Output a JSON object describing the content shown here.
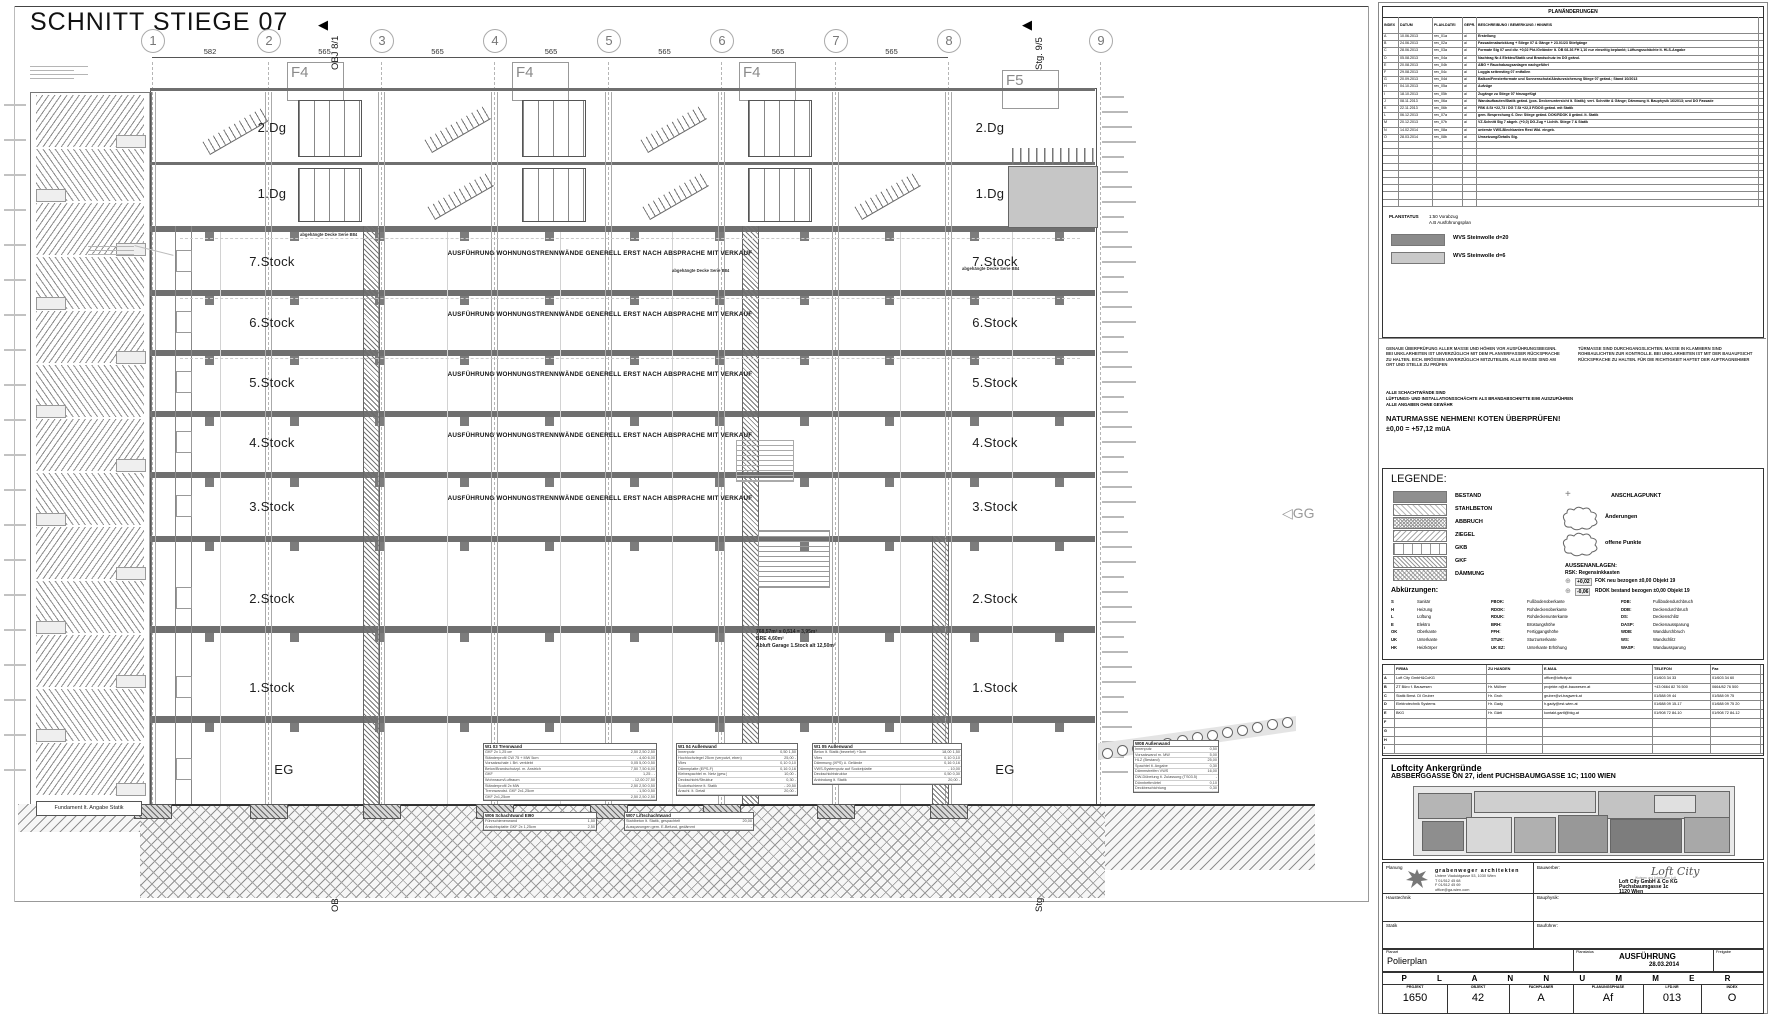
{
  "sheet_title": "SCHNITT STIEGE 07",
  "drawing": {
    "grid_numbers": [
      "1",
      "2",
      "3",
      "4",
      "5",
      "6",
      "7",
      "8",
      "9"
    ],
    "dims": [
      "582",
      "565",
      "565",
      "565",
      "565",
      "565",
      "565"
    ],
    "markers": [
      {
        "label": "OBJ 8/1"
      },
      {
        "label": "Stg. 9/5"
      }
    ],
    "facade_labels": [
      "F4",
      "F4",
      "F4",
      "F5"
    ],
    "floor_labels": [
      "2.Dg",
      "1.Dg",
      "7.Stock",
      "6.Stock",
      "5.Stock",
      "4.Stock",
      "3.Stock",
      "2.Stock",
      "1.Stock",
      "EG"
    ],
    "wall_note": "AUSFÜHRUNG WOHNUNGSTRENNWÄNDE GENERELL ERST NACH ABSPRACHE MIT VERKAUF",
    "ceiling_note": "abgehängte Decke Serie B84",
    "area_notes": [
      "768,57m² x 0,514 = 3,95m³",
      "BRE 4,60m²",
      "Abluft Garage 1.Stock alt 12,50m²"
    ],
    "foundation_note": "Fundament lt. Angabe Statik",
    "gg_label": "GG",
    "spec_tables": [
      {
        "title": "W1 03 Trennwand",
        "rows": [
          [
            "GKF 2x 1,25 cm",
            "2,50 2,50 2,50"
          ],
          [
            "Ständerprofil CW 75 + MW 5cm",
            "- 4,60 6,00"
          ],
          [
            "Vorsatzschale i. Brt. verklebt",
            "0,05 5,00 0,50"
          ],
          [
            "Beton/Brandschutzpl. m. Anstrich",
            "7,50 7,50 6,00"
          ],
          [
            "GKF",
            "1,25 - -"
          ],
          [
            "Wohnraum/Luftraum",
            "- 12,00 27,50"
          ],
          [
            "Ständerprofil 2x MW",
            "2,50 2,50 0,50"
          ],
          [
            "Trennwandst. GKF 2x1,25cm",
            "- 1,50 0,50"
          ],
          [
            "GKF 2x1,25cm",
            "2,50 2,50 2,50"
          ]
        ]
      },
      {
        "title": "W1 04 Außenwand",
        "rows": [
          [
            "Innenputz",
            "0,50 1,50"
          ],
          [
            "Hochlochziegel 25cm (verputzt, eben)",
            "25,00 -"
          ],
          [
            "Vlies",
            "0,10 0,10"
          ],
          [
            "Dämmplatte (EPS-F)",
            "0,16 0,16"
          ],
          [
            "Klebespachtel m. Netz (gew.)",
            "10,00 -"
          ],
          [
            "Deckschicht/Struktur",
            "0,30 -"
          ],
          [
            "Sockelschiene lt. Statik",
            "- 20,50"
          ],
          [
            "Anschl. lt. Detail",
            "20,00 -"
          ]
        ]
      },
      {
        "title": "W1 05 Außenwand",
        "rows": [
          [
            "Beton lt. Statik (bewehrt) +3cm",
            "18,00 1,50"
          ],
          [
            "Vlies",
            "0,10 0,10"
          ],
          [
            "Dämmung (XPS) ü. Gelände",
            "0,16 0,16"
          ],
          [
            "VWS-Systemputz auf Sockelplatte",
            "- 10,00"
          ],
          [
            "Deckschichtstruktur",
            "0,50 0,30"
          ],
          [
            "Anbindung lt. Statik",
            "20,00 -"
          ]
        ]
      },
      {
        "title": "W06 Schachtwand EI90",
        "rows": [
          [
            "Führschienenwand",
            "1,50"
          ],
          [
            "Ansichtsplatte GKF 2x 1,25cm",
            "2,50"
          ]
        ]
      },
      {
        "title": "W07 Liftschachtwand",
        "rows": [
          [
            "Stahlbeton lt. Statik, gespachtelt",
            "20,00"
          ],
          [
            "Aussparungen gem. E-Befund, gedämmt",
            "-"
          ]
        ]
      },
      {
        "title": "W08 Außenwand",
        "rows": [
          [
            "Innenputz",
            "0,50"
          ],
          [
            "Vorsatzwand m. MW",
            "5,00"
          ],
          [
            "HLZ (Bestand)",
            "25,00"
          ],
          [
            "Spachtel lt. Angabe",
            "0,30"
          ],
          [
            "Dämmstreifen VWS",
            "16,00"
          ],
          [
            "DW-Dübelung lt. Zulassung (TS03.5)",
            "-"
          ],
          [
            "Dünnbettmörtel",
            "0,10"
          ],
          [
            "Deckbeschichtung",
            "0,30"
          ]
        ]
      }
    ]
  },
  "titleblock": {
    "revisions": {
      "box_title": "PLANÄNDERUNGEN",
      "headers": [
        "INDEX",
        "DATUM",
        "PLAN-DATEI",
        "GEPR.",
        "BESCHREIBUNG / BEMERKUNG / HINWEIS"
      ],
      "rows": [
        [
          "A",
          "10.06.2013",
          "rev_01a",
          "ai",
          "Erstellung"
        ],
        [
          "B",
          "24.06.2013",
          "rev_02a",
          "ai",
          "Fassadenabwicklung + Stiege 07 & Gänge + 23.01/23 Stiefgänge"
        ],
        [
          "C",
          "28.06.2013",
          "rev_03a",
          "ai",
          "Formate Stg 07 und div. +0,02 Pkt./Geländer lt. ÖB 08-36 FH 1,10 nur einseitig beplankt; Lüftungsschächte lt. HLS-Angabe"
        ],
        [
          "D",
          "05.08.2013",
          "rev_04a",
          "ai",
          "Nachtrag Nr.4 Elektro/Statik und Brandschutz im DG geänd."
        ],
        [
          "E",
          "20.08.2013",
          "rev_04b",
          "ai",
          "ABG + Rauchabzugsanlagen nachgeführt"
        ],
        [
          "F",
          "29.08.2013",
          "rev_04c",
          "ai",
          "Loggia seitenstieg 07 entfallen"
        ],
        [
          "G",
          "20.09.2013",
          "rev_04d",
          "ai",
          "Balkon/Fensterformate und Sonnenschutz/Absturzsicherung Stiege 07 geänd.; Stand 10/2013"
        ],
        [
          "H",
          "04.10.2013",
          "rev_05a",
          "ai",
          "Aufzüge"
        ],
        [
          "I",
          "18.10.2013",
          "rev_05b",
          "ai",
          "Zugänge zu Stiege 07 hinzugefügt"
        ],
        [
          "J",
          "08.11.2013",
          "rev_06a",
          "ai",
          "Wandaufbauten/Statik geänd. (pos. Deckenuntersicht lt. Statik); vert. Schnitte & Gänge; Dämmung lt. Bauphysik 16/2013; und DG Fassade"
        ],
        [
          "K",
          "22.11.2013",
          "rev_06b",
          "ai",
          "FBK 8.St +22,73 / DG 7.St +22,3 F/DOG geänd. mit Statik"
        ],
        [
          "L",
          "06.12.2013",
          "rev_07a",
          "ai",
          "gem. Besprechung 6. Dez: Stiege geänd. DOK/RDOK 8 geänd. lt. Statik"
        ],
        [
          "M",
          "20.12.2013",
          "rev_07b",
          "ai",
          "VZ-Schnitt Stg 7 abgeh. (+0,0) DG-Zug + Lichth. Stiege 7 & Statik"
        ],
        [
          "N",
          "14.02.2014",
          "rev_08a",
          "ai",
          "unterste VWS-Blechkanten Rest Wbl. eingeb."
        ],
        [
          "O",
          "28.03.2014",
          "rev_08b",
          "ai",
          "Umsetzung/Details Stg."
        ]
      ],
      "empty_rows": 9
    },
    "planstatus": {
      "label": "PLANSTATUS",
      "lines": [
        "1:50  Vorabzug",
        "A.B  Ausführungsplan"
      ]
    },
    "swatches": [
      {
        "label": "WVS Steinwolle d=20",
        "color": "#8b8b8b"
      },
      {
        "label": "WVS Steinwolle d=6",
        "color": "#c9c9c9"
      }
    ],
    "notes": {
      "col1": "GENAUE ÜBERPRÜFUNG ALLER MASSE UND HÖHEN VOR AUSFÜHRUNGSBEGINN. BEI UNKLARHEITEN IST UNVERZÜGLICH MIT DEM PLANVERFASSER RÜCKSPRACHE ZU HALTEN. EICH. BRÖSSEN UNVERZÜGLICH MITZUTEILEN. ALLE MASSE SIND AM ORT UND STELLE ZU PRÜFEN",
      "col2": "TÜRMASSE SIND DURCHGANGSLICHTEN. MASSE IN KLAMMERN SIND ROHBAULICHTEN ZUR KONTROLLE. BEI UNKLARHEITEN IST MIT DER BAUAUFSICHT RÜCKSPRACHE ZU HALTEN. FÜR DIE RICHTIGKEIT HAFTET DER AUFTRAGNEHMER",
      "line3": "ALLE SCHACHTWÄNDE SIND",
      "line4": "LÜFTUNGS- UND INSTALLATIONSSCHÄCHTE ALS BRANDABSCHNITTE EI90 AUSZUFÜHREN",
      "line5": "ALLE ANGABEN OHNE GEWÄHR",
      "bold": "NATURMASSE NEHMEN! KOTEN ÜBERPRÜFEN!",
      "datum": "±0,00 = +57,12 müA"
    },
    "legend": {
      "title": "LEGENDE:",
      "items": [
        {
          "label": "BESTAND",
          "fill": "leg-solid"
        },
        {
          "label": "STAHLBETON",
          "fill": "leg-diag-light"
        },
        {
          "label": "ABBRUCH",
          "fill": "leg-cross"
        },
        {
          "label": "ZIEGEL",
          "fill": "leg-diag"
        },
        {
          "label": "GKB",
          "fill": "leg-vlines"
        },
        {
          "label": "GKF",
          "fill": "leg-diag2"
        },
        {
          "label": "DÄMMUNG",
          "fill": "leg-crossdiag"
        }
      ],
      "anschlag": {
        "symbol": "+",
        "label": "ANSCHLAGPUNKT"
      },
      "cloud1": "Änderungen",
      "cloud2": "offene Punkte",
      "aussen_title": "AUSSENANLAGEN:",
      "aussen_sub": "RSK: Regensinkkasten",
      "aussen_rows": [
        {
          "sym": "⊕",
          "val": "+0,02",
          "label": "FOK neu bezogen ±0,00 Objekt 19"
        },
        {
          "sym": "⊕",
          "val": "-0,06",
          "label": "RDOK bestand bezogen ±0,00 Objekt 19"
        }
      ],
      "abk_title": "Abkürzungen:",
      "abk_col1": [
        [
          "S",
          "Sanitär"
        ],
        [
          "H",
          "Heizung"
        ],
        [
          "L",
          "Lüftung"
        ],
        [
          "E",
          "Elektro"
        ],
        [
          "OK",
          "Oberkante"
        ],
        [
          "UK",
          "Unterkante"
        ],
        [
          "HK",
          "Heizkörper"
        ]
      ],
      "abk_col2": [
        [
          "FBOK:",
          "Fußbodenoberkante"
        ],
        [
          "RDOK:",
          "Rohdeckenoberkante"
        ],
        [
          "RDUK:",
          "Rohdeckenunterkante"
        ],
        [
          "BRH:",
          "Brüstungshöhe"
        ],
        [
          "FFH:",
          "Fertiggangshöhe"
        ],
        [
          "STUK:",
          "Sturzunterkante"
        ],
        [
          "UK EZ:",
          "Unterkante Erhöhung"
        ]
      ],
      "abk_col3": [
        [
          "FDB:",
          "Fußbodendurchbruch"
        ],
        [
          "DDB:",
          "Deckendurchbruch"
        ],
        [
          "DS:",
          "Deckenschlitz"
        ],
        [
          "DASP:",
          "Deckenaussparung"
        ],
        [
          "WDB:",
          "Wanddurchbruch"
        ],
        [
          "WS:",
          "Wandschlitz"
        ],
        [
          "WASP:",
          "Wandaussparung"
        ]
      ]
    },
    "contacts": {
      "headers": [
        "",
        "FIRMA",
        "ZU HANDEN",
        "E-MAIL",
        "TELEFON",
        "Fax"
      ],
      "rows": [
        [
          "A",
          "Loft City GmbH&CoKG",
          "",
          "office@loftcity.at",
          "01/603 34 33",
          "01/603 34 60"
        ],
        [
          "B",
          "ZT Büro f. Bauwesen",
          "Hr. Müllner",
          "projekte.n@zt-bauwesen.at",
          "+43 0664 82 76 500",
          "0664/82 76 500"
        ],
        [
          "C",
          "Statik Bmst. DI Gruber",
          "Hr. Groh",
          "gruber@zt-tragwerk.at",
          "01/588 09 44",
          "01/588 09 75"
        ],
        [
          "D",
          "Elektrotechnik Systems",
          "Hr. Gady",
          "h.gady@est-wien.at",
          "01/688 09 15-17",
          "01/688 09 75 20"
        ],
        [
          "E",
          "BKG",
          "Hr. Gärtl",
          "kontakt.gartl@bkg.at",
          "01/908 72 84-10",
          "01/908 72 84-12"
        ],
        [
          "F",
          "",
          "",
          "",
          "",
          ""
        ],
        [
          "G",
          "",
          "",
          "",
          "",
          ""
        ],
        [
          "H",
          "",
          "",
          "",
          "",
          ""
        ],
        [
          "I",
          "",
          "",
          "",
          "",
          ""
        ]
      ]
    },
    "project": {
      "name": "Loftcity Ankergründe",
      "address": "ABSBERGGASSE ON 27, ident PUCHSBAUMGASSE 1C; 1100 WIEN"
    },
    "parties": {
      "planung_label": "Planung",
      "planung_firm": "grabenweger architekten",
      "planung_lines": [
        "Untere Viaduktgasse 53, 1030 Wien",
        "T 01/512 45 68",
        "F 01/512 45 69",
        "office@ga-wien.com"
      ],
      "bauwerber_label": "Bauwerber:",
      "bauwerber_logo": "Loft City",
      "bauwerber_tag": "Wohnen und Arbeiten im Loft",
      "bauwerber_lines": [
        "Loft City GmbH & Co KG",
        "Puchsbaumgasse 1c",
        "1120 Wien"
      ],
      "haustechnik_label": "Haustechnik",
      "bauphysik_label": "Bauphysik:",
      "statik_label": "Statik",
      "baufuehrer_label": "Bauführer:"
    },
    "bottom": {
      "planart_label": "Planart",
      "planart": "Polierplan",
      "status_label": "Planstatus",
      "status": "AUSFÜHRUNG",
      "status_date": "28.03.2014",
      "freigabe_label": "Freigabe",
      "inhalt_label": "Planinhalt",
      "inhalt_big": "LÄNGSSCHNITT",
      "inhalt_sub": "STIEGE 07",
      "meta": [
        [
          "Maßstab",
          "1:50"
        ],
        [
          "Format",
          "1,40 m²"
        ],
        [
          "gez.",
          "GRCH"
        ],
        [
          "Projekt",
          "GRCH"
        ],
        [
          "Ges.",
          ""
        ],
        [
          "File",
          "1650_42A_Af_013"
        ]
      ],
      "plannummer": "P L A N N U M M E R",
      "num_labels": [
        "PROJEKT",
        "OBJEKT",
        "FACHPLANER",
        "PLANUNGSPHASE",
        "LFD.NR",
        "INDEX"
      ],
      "num_values": [
        "1650",
        "42",
        "A",
        "Af",
        "013",
        "O"
      ]
    }
  }
}
